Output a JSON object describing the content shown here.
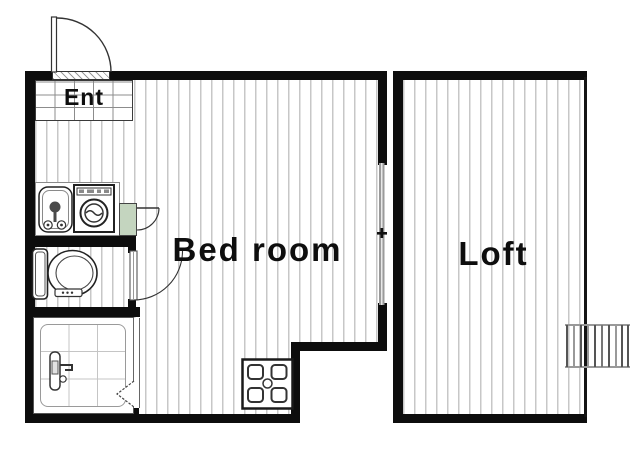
{
  "plan_title": "Apartment floor plan",
  "rooms": {
    "entrance": {
      "label": "Ent"
    },
    "bedroom": {
      "label": "Bed room"
    },
    "loft": {
      "label": "Loft"
    }
  },
  "fixtures": [
    "entry-door",
    "entrance-mat",
    "kitchen-sink",
    "washing-machine",
    "refrigerator-cabinet",
    "cabinet-door",
    "toilet",
    "toilet-door",
    "shower-unit",
    "shower-mixer",
    "shower-folding-door",
    "washing-machine-pan",
    "sliding-window",
    "loft-ladder"
  ],
  "colors": {
    "wall": "#0d0d0d",
    "floor_stripe": "#c7c7c7",
    "grid_line": "#8c8c8c",
    "tile_line": "#c5c5c5",
    "cabinet_green": "#c4d5bf",
    "window_gray": "#9a9a9a",
    "fixture_line": "#2a2a2a"
  }
}
